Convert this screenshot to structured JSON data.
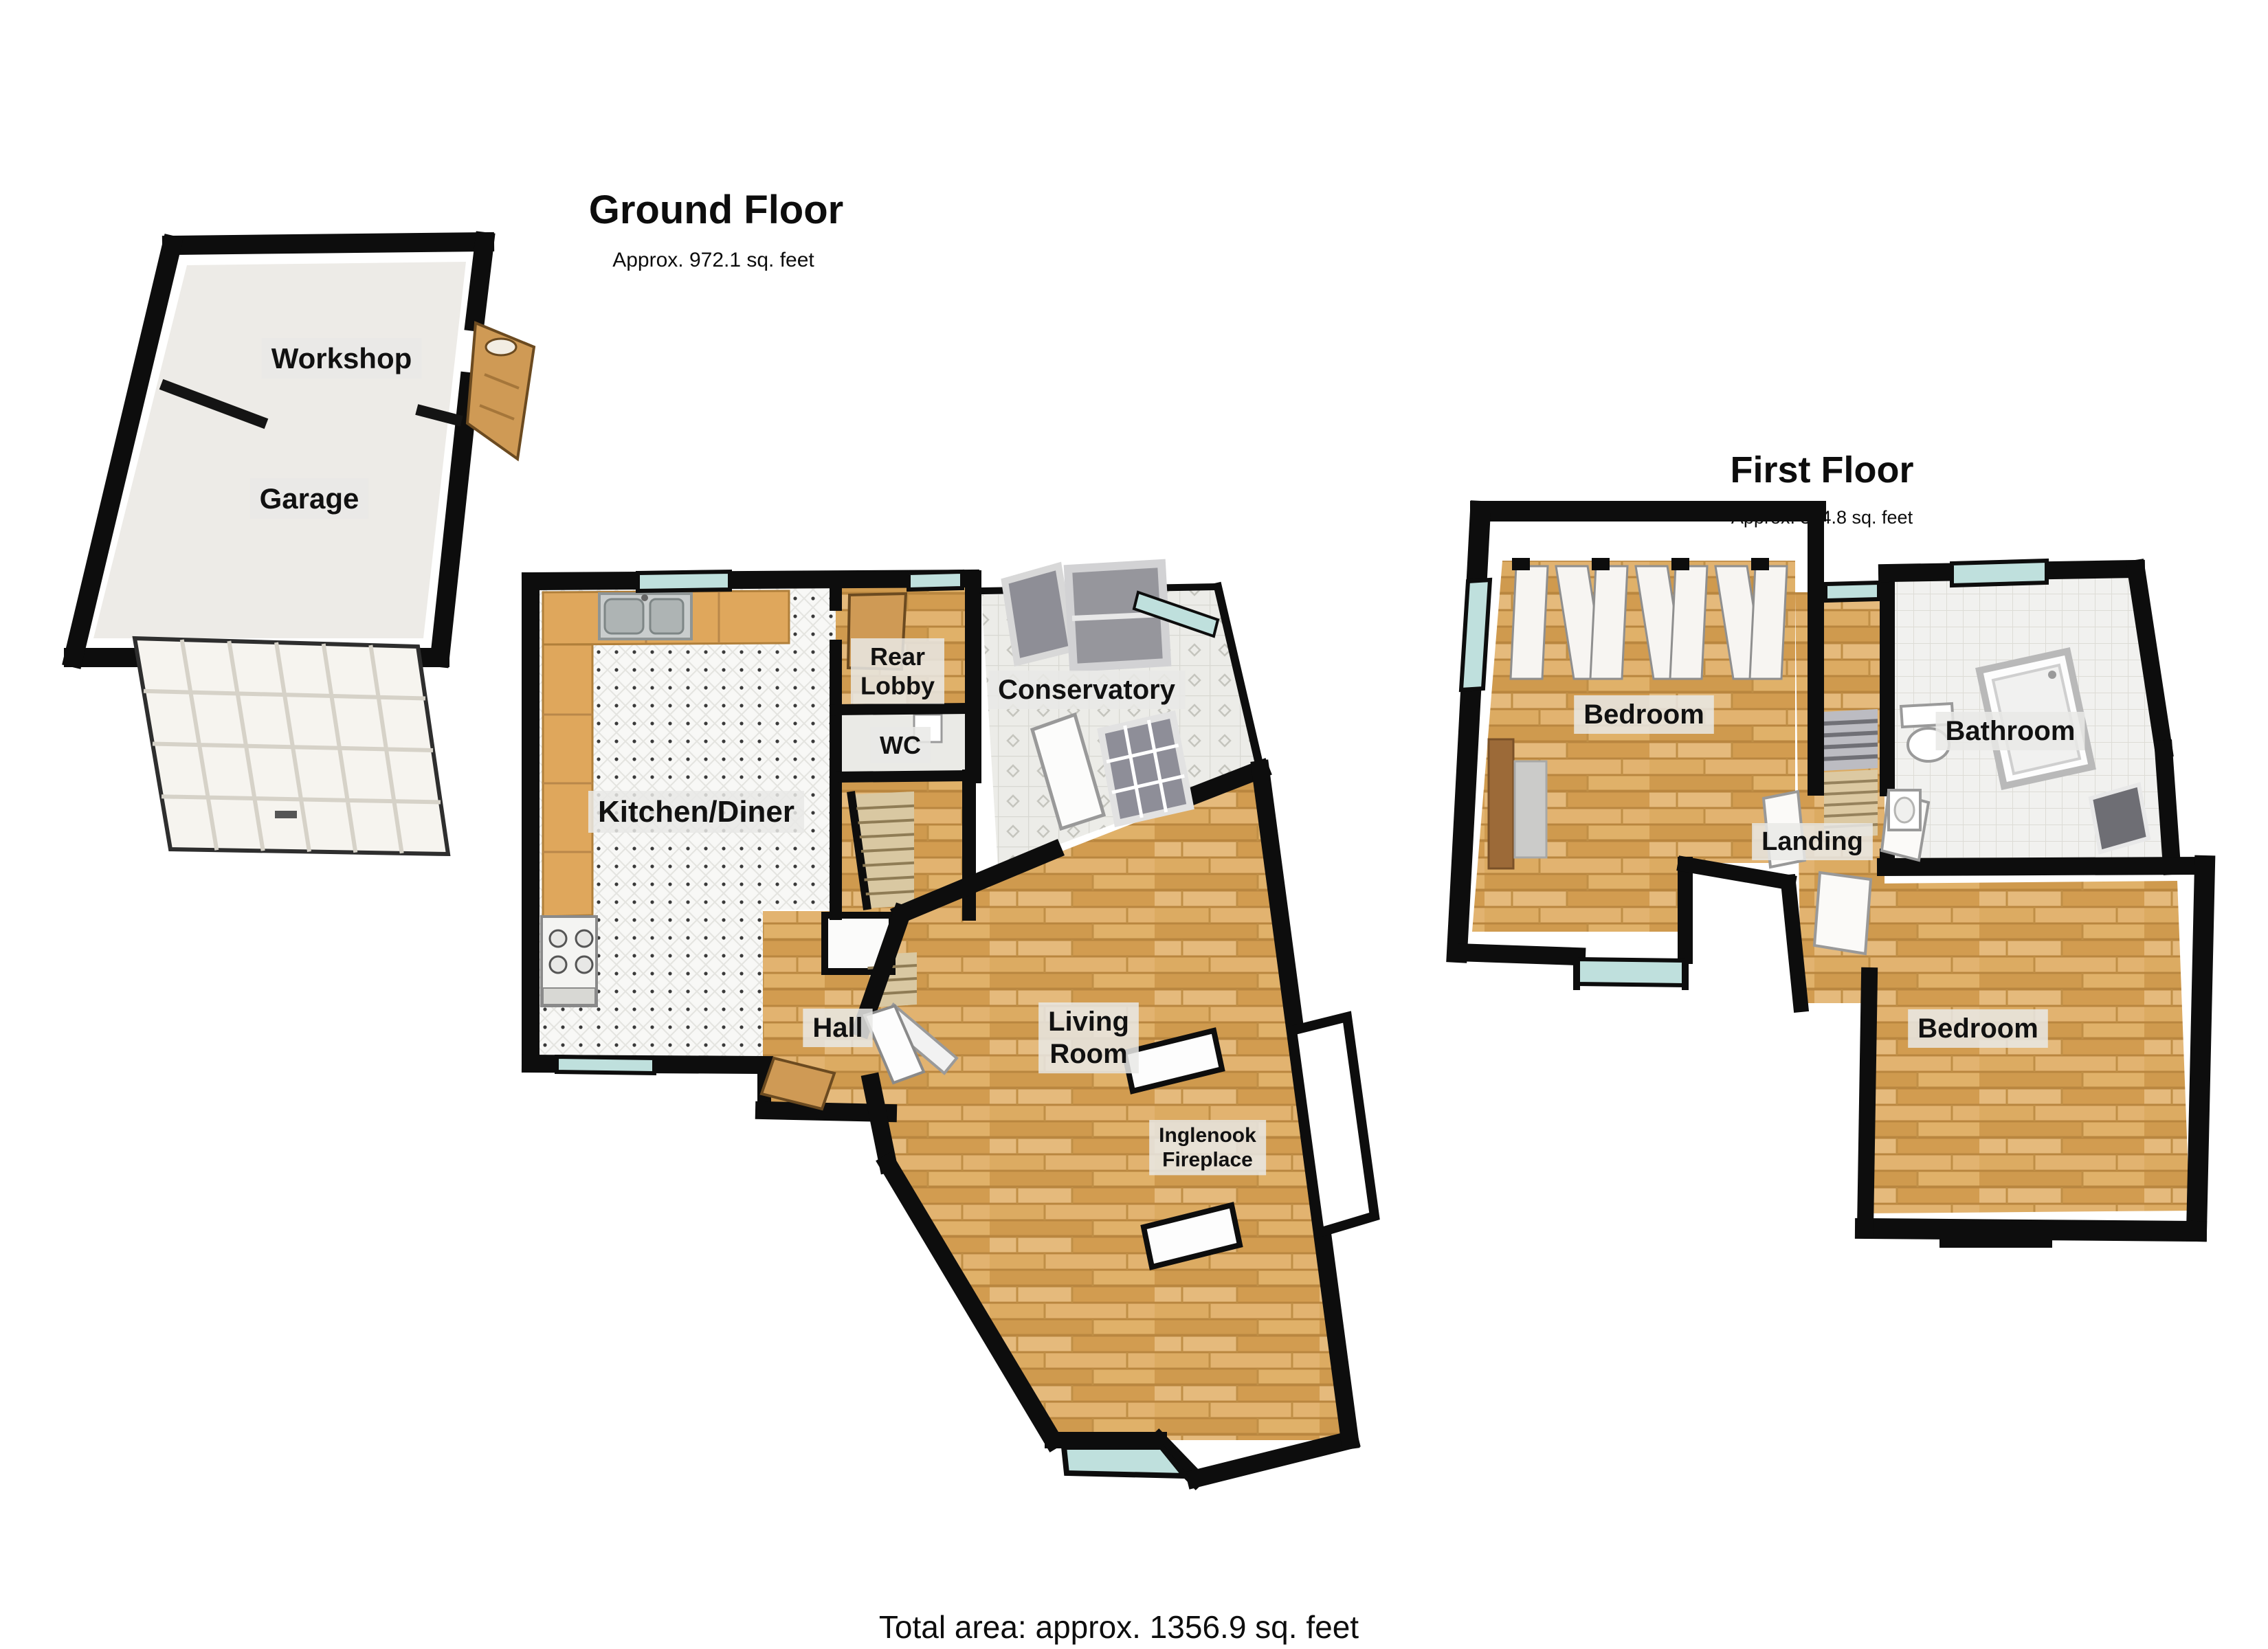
{
  "floorplan": {
    "ground": {
      "title": "Ground Floor",
      "area": "Approx. 972.1 sq. feet",
      "rooms": {
        "workshop": "Workshop",
        "garage": "Garage",
        "kitchen_diner": "Kitchen/Diner",
        "rear_lobby": "Rear Lobby",
        "wc": "WC",
        "conservatory": "Conservatory",
        "hall": "Hall",
        "living_room": "Living Room"
      },
      "features": {
        "inglenook": "Inglenook Fireplace"
      }
    },
    "first": {
      "title": "First Floor",
      "area": "Approx. 384.8 sq. feet",
      "rooms": {
        "bedroom_front": "Bedroom",
        "landing": "Landing",
        "bathroom": "Bathroom",
        "bedroom_back": "Bedroom"
      }
    },
    "total_area": "Total area: approx. 1356.9 sq. feet",
    "colors": {
      "wall": "#0d0d0d",
      "wood_floor": "#d9a75f",
      "kitchen_tile": "#f8f8f6",
      "conservatory_tile": "#ecece8",
      "bath_tile": "#f1f1ef",
      "window_glass": "#bfe0dd",
      "counter_wood": "#dfa75c",
      "door_wood": "#cf9a55",
      "glass_panel_gray": "#96969c",
      "label_bg": "#e9e9e6",
      "label_text": "#111111"
    }
  }
}
